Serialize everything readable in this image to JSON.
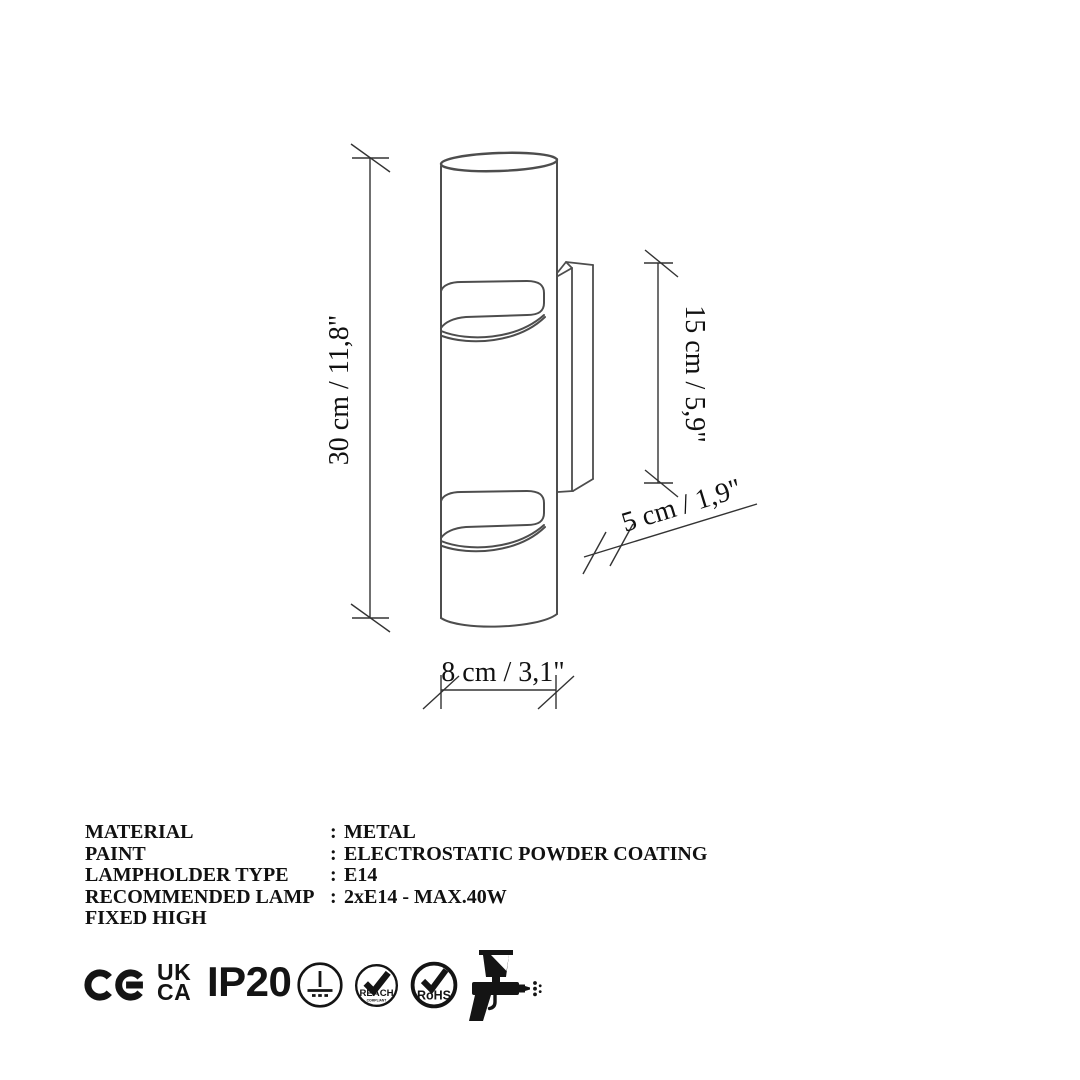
{
  "diagram": {
    "dim_height": "30 cm / 11,8\"",
    "dim_bracket_height": "15 cm / 5,9\"",
    "dim_depth": "5 cm / 1,9\"",
    "dim_width": "8 cm / 3,1\""
  },
  "specs": {
    "rows": [
      {
        "label": "MATERIAL",
        "colon": ":",
        "value": "METAL"
      },
      {
        "label": "PAINT",
        "colon": ":",
        "value": "ELECTROSTATIC POWDER COATING"
      },
      {
        "label": "LAMPHOLDER TYPE",
        "colon": ":",
        "value": "E14"
      },
      {
        "label": "RECOMMENDED LAMP",
        "colon": ":",
        "value": "2xE14 - MAX.40W"
      },
      {
        "label": "FIXED HIGH",
        "colon": "",
        "value": ""
      }
    ]
  },
  "badges": {
    "ukca_line1": "UK",
    "ukca_line2": "CA",
    "ip_rating": "IP20",
    "reach_label": "REACH",
    "reach_sub": "COMPLIANT",
    "rohs_label": "RoHS"
  },
  "colors": {
    "drawing_line": "#4d4d4d",
    "dimension_line": "#333333",
    "text": "#111111",
    "icon": "#141414",
    "background": "#ffffff"
  }
}
